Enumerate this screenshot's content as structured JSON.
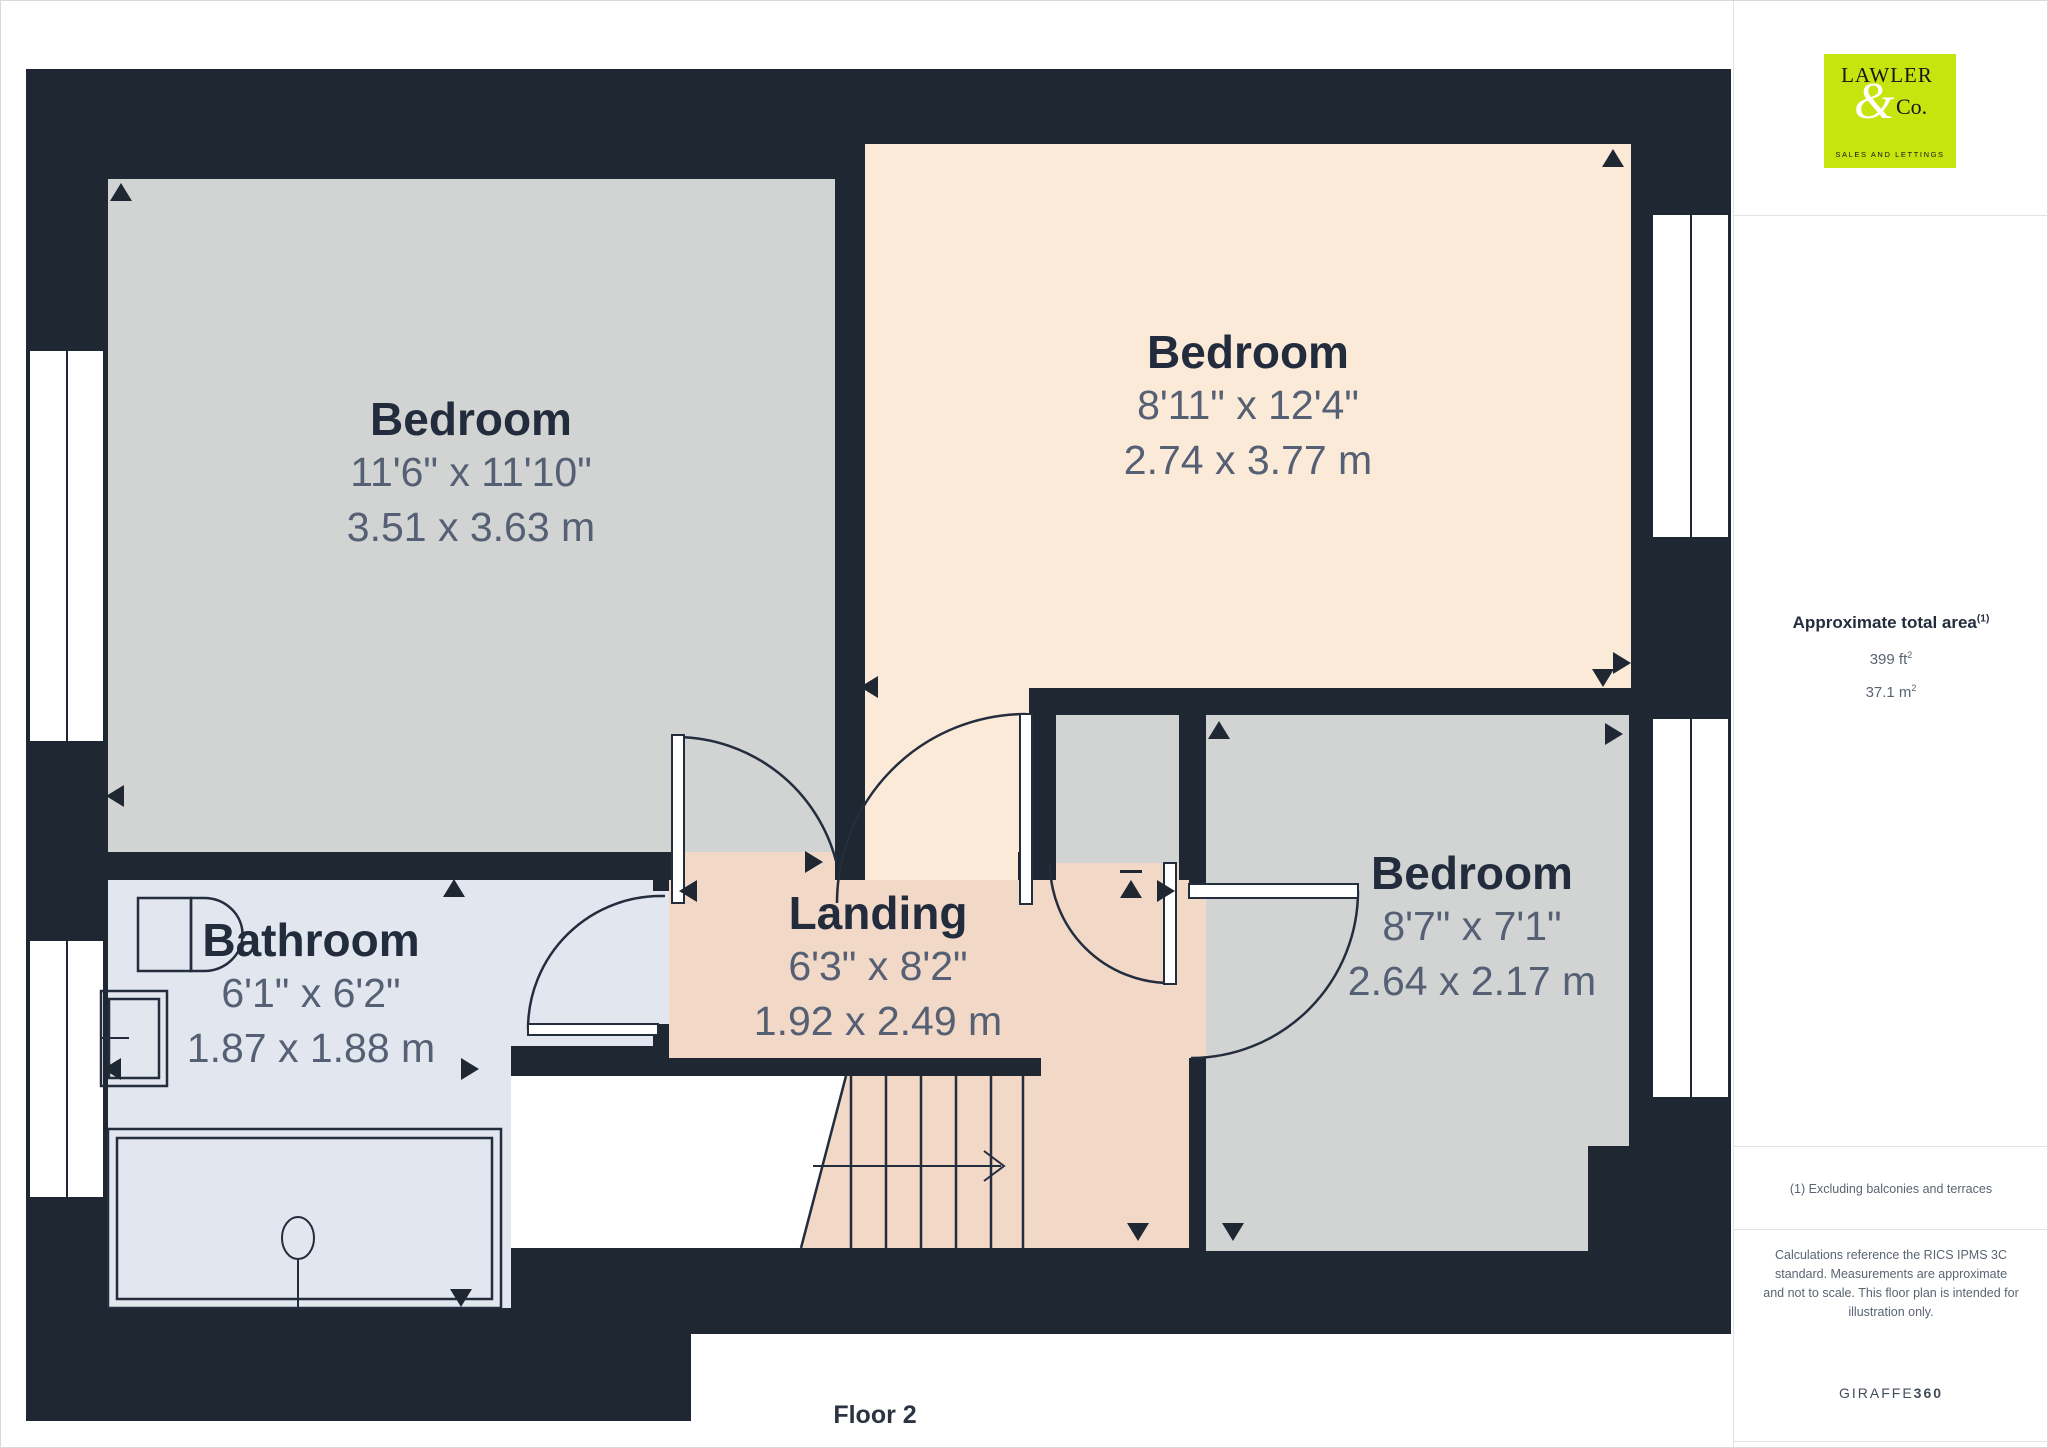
{
  "page": {
    "floor_label": "Floor 2"
  },
  "rooms": {
    "bedroom1": {
      "name": "Bedroom",
      "imperial": "11'6\" x 11'10\"",
      "metric": "3.51 x 3.63 m"
    },
    "bedroom2": {
      "name": "Bedroom",
      "imperial": "8'11\" x 12'4\"",
      "metric": "2.74 x 3.77 m"
    },
    "bedroom3": {
      "name": "Bedroom",
      "imperial": "8'7\" x 7'1\"",
      "metric": "2.64 x 2.17 m"
    },
    "bathroom": {
      "name": "Bathroom",
      "imperial": "6'1\" x 6'2\"",
      "metric": "1.87 x 1.88 m"
    },
    "landing": {
      "name": "Landing",
      "imperial": "6'3\" x 8'2\"",
      "metric": "1.92 x 2.49 m"
    }
  },
  "sidebar": {
    "logo": {
      "line1": "LAWLER",
      "amp": "&",
      "line2": "Co.",
      "tagline": "SALES AND LETTINGS"
    },
    "area": {
      "title": "Approximate total area",
      "title_sup": "(1)",
      "imperial_value": "399 ft",
      "imperial_sup": "2",
      "metric_value": "37.1 m",
      "metric_sup": "2"
    },
    "footnote": "(1) Excluding balconies and terraces",
    "disclaimer": "Calculations reference the RICS IPMS 3C standard. Measurements are approximate and not to scale. This floor plan is intended for illustration only.",
    "brand": {
      "name": "GIRAFFE",
      "suffix": "360"
    }
  },
  "colors": {
    "wall": "#1f2733",
    "bedroom_fill": "#d2d3d3",
    "bedroom2_fill": "#fcead9",
    "landing_fill": "#f1d8c7",
    "bathroom_fill": "#e2e6ef",
    "brand_lime": "#c6e40e",
    "title_text": "#222c3c",
    "dim_text": "#556074"
  }
}
